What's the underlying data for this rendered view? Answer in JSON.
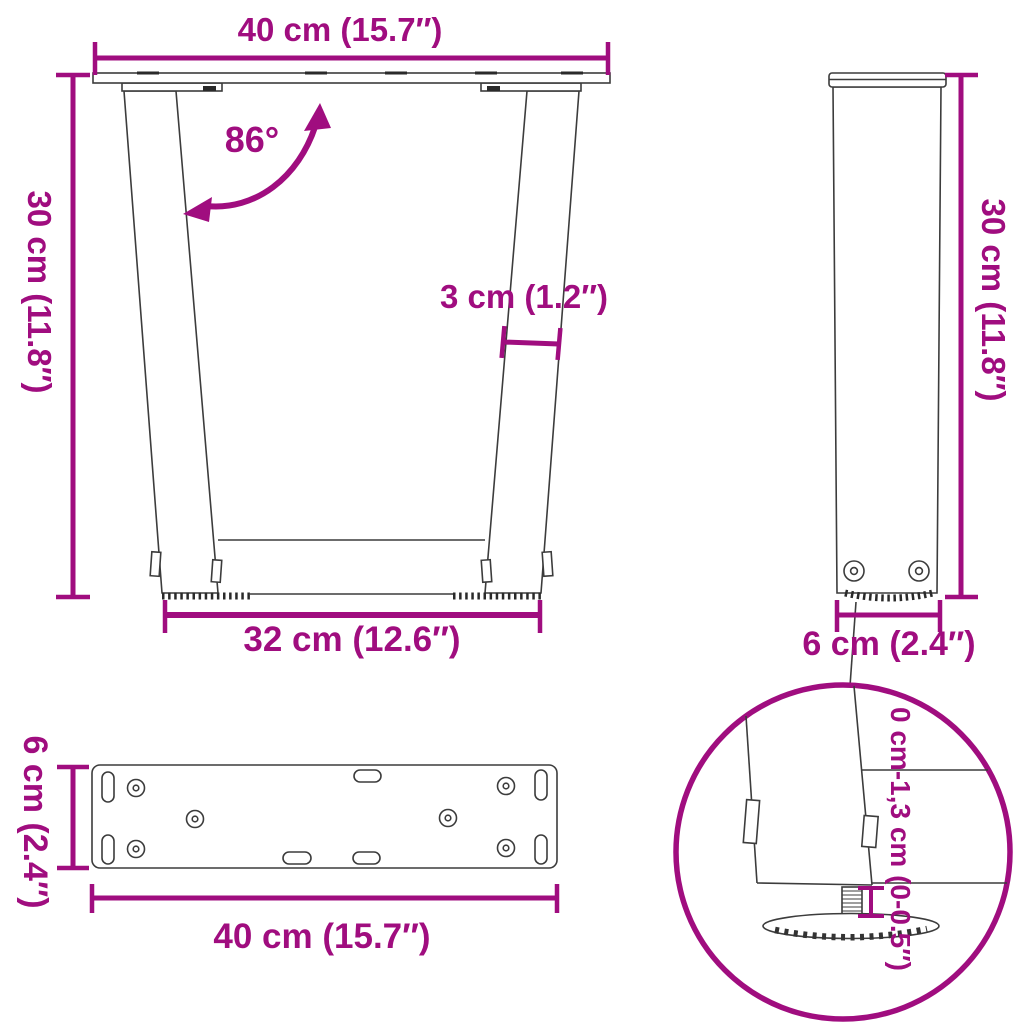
{
  "colors": {
    "dimension_accent": "#a00d7f",
    "drawing_line": "#3c3c3c",
    "background": "#ffffff"
  },
  "front_view": {
    "top_width": "40 cm (15.7″)",
    "height": "30 cm (11.8″)",
    "angle": "86°",
    "leg_thickness": "3 cm (1.2″)",
    "bottom_width": "32 cm (12.6″)"
  },
  "side_view": {
    "height": "30 cm (11.8″)",
    "depth": "6 cm (2.4″)"
  },
  "plate_top_view": {
    "depth": "6 cm (2.4″)",
    "width": "40 cm (15.7″)"
  },
  "foot_detail": {
    "height_adjustment": "0 cm-1,3 cm (0-0.5″)"
  }
}
